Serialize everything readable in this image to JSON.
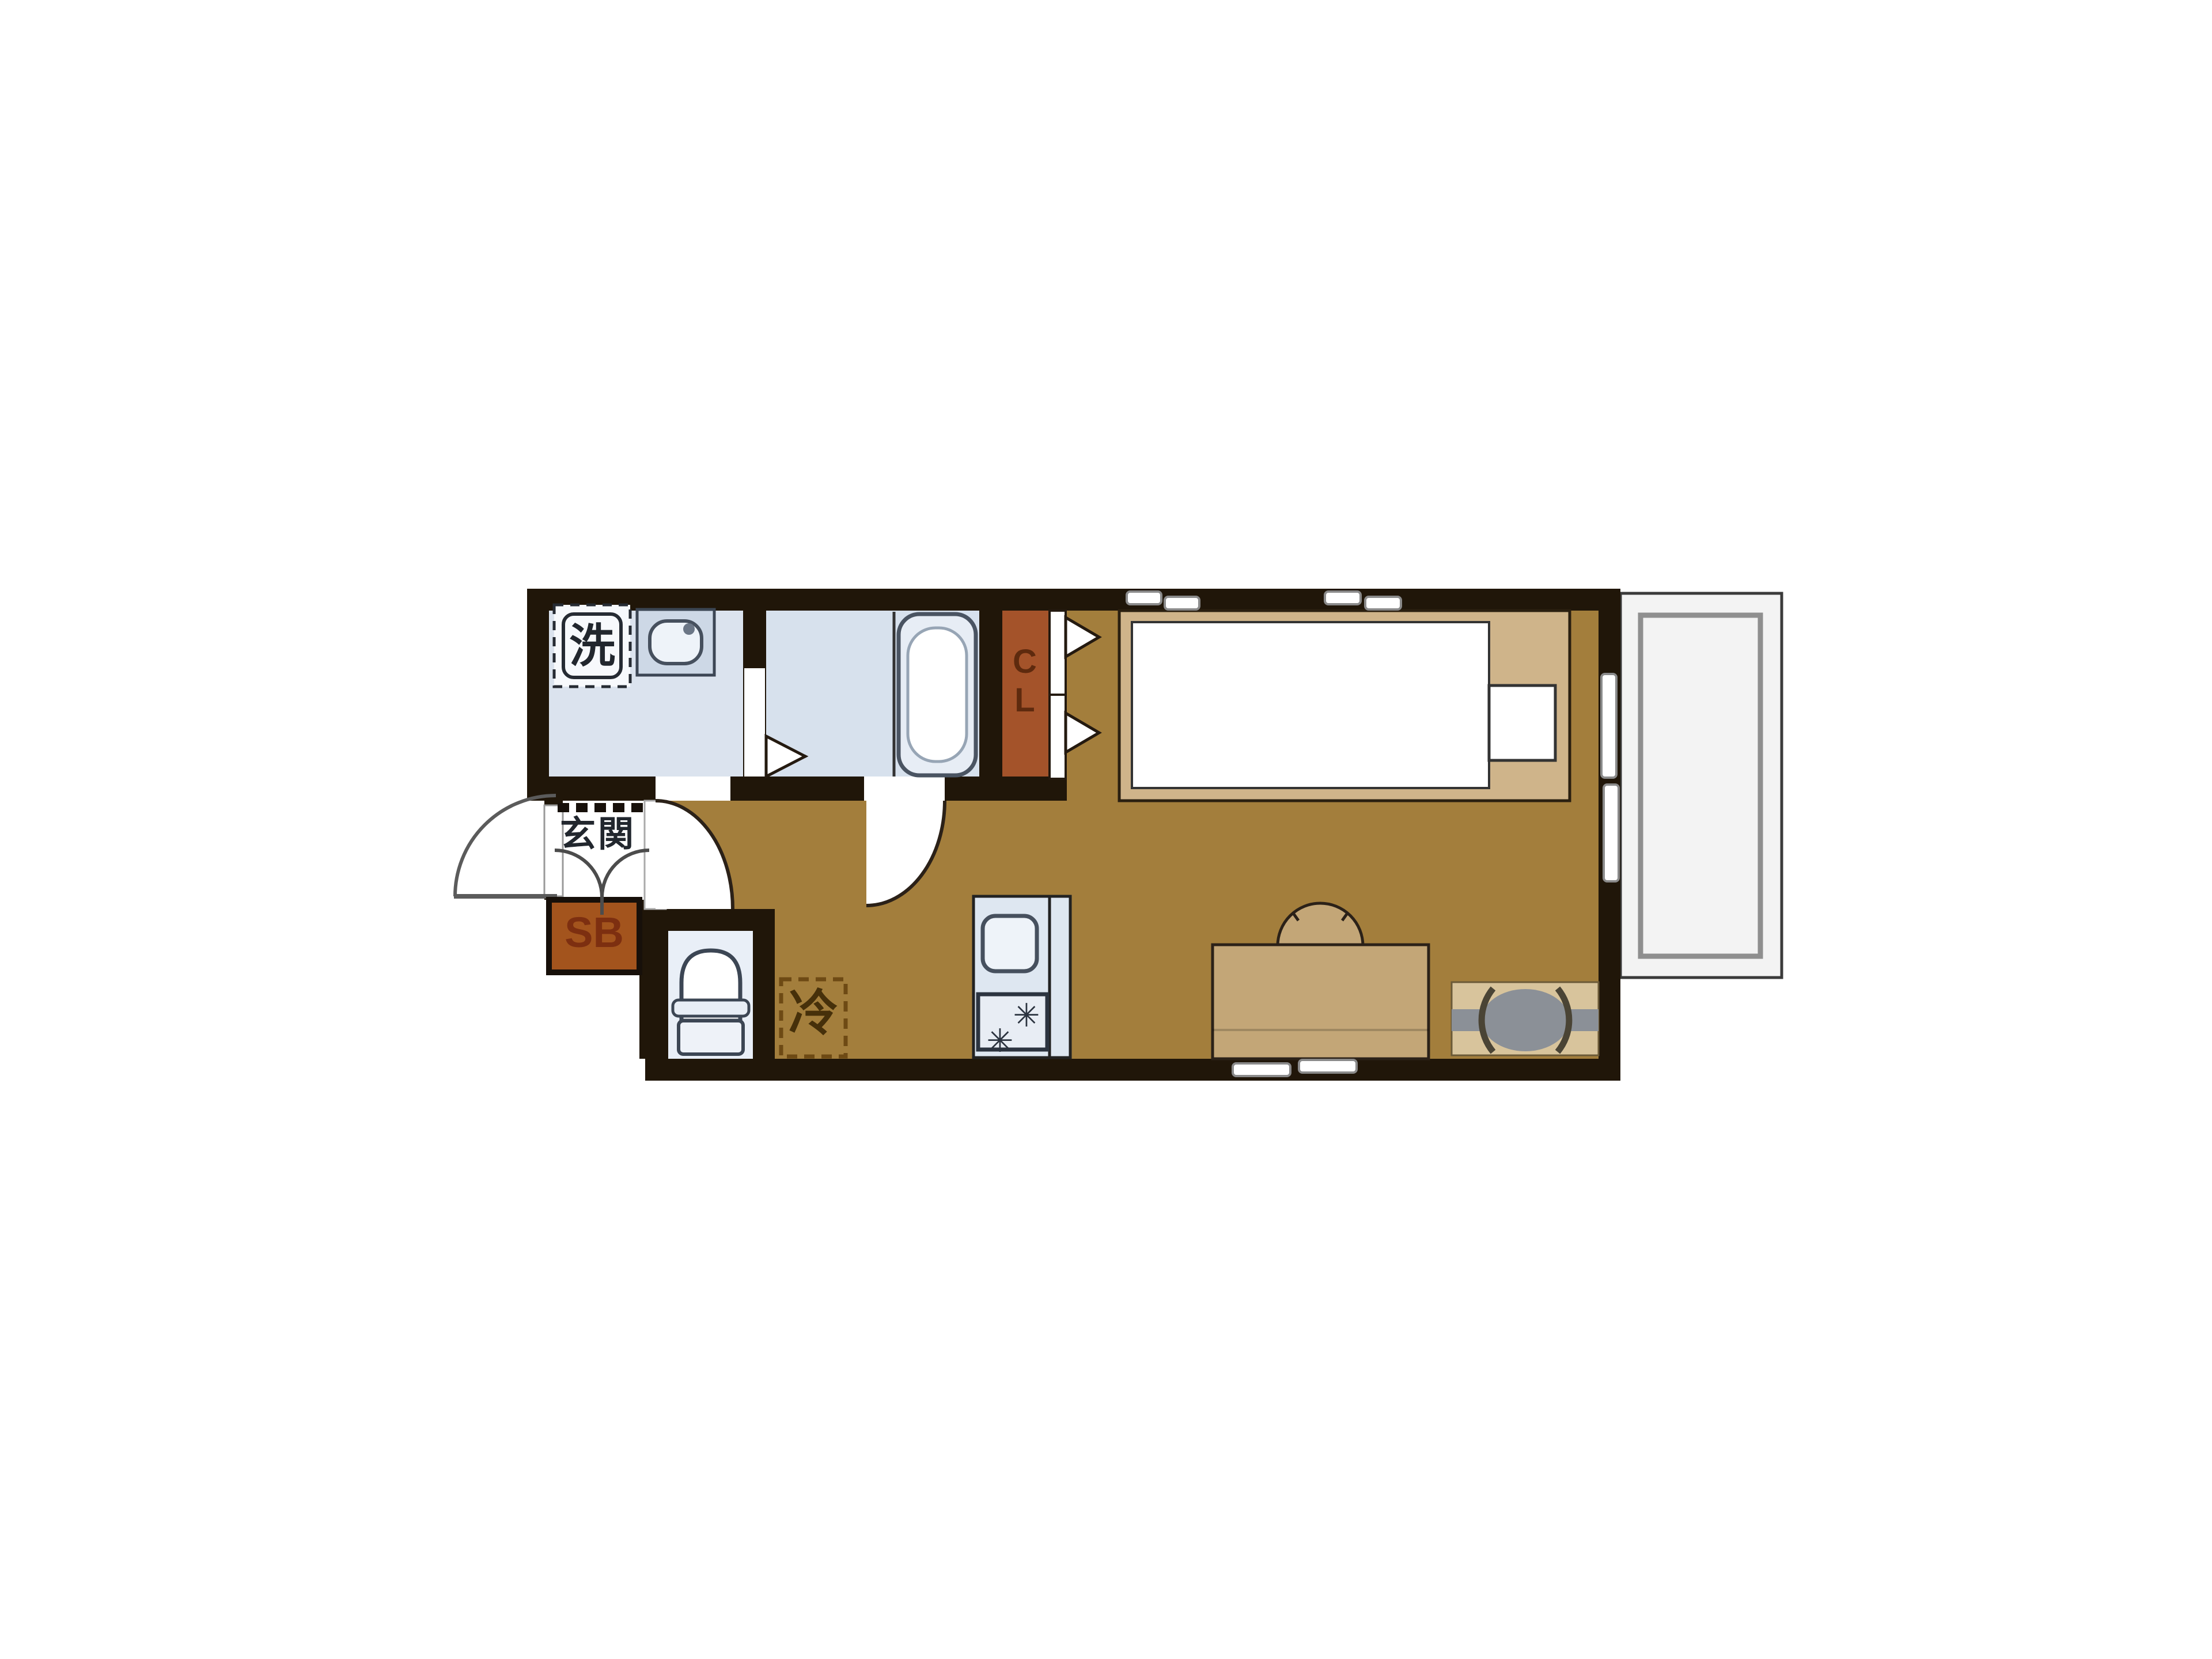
{
  "title": "one-room-apartment-floor-plan",
  "labels": {
    "entrance": "玄関",
    "shoe_box": "SB",
    "closet": "CL",
    "washing_machine": "洗",
    "refrigerator": "冷"
  },
  "colors": {
    "wall": "#201609",
    "floor": "#a37e3c",
    "washroom": "#dbe3ee",
    "bathroom": "#d7e1ed",
    "toilet": "#e9eff7",
    "kitchen": "#dee7f1",
    "closet": "#a4532a",
    "shoebox": "#a3541d",
    "bed_frame": "#cfb48a",
    "furniture_tan": "#c3a677",
    "tv_stand": "#d8c49c",
    "appliance_gray": "#8b9097",
    "balcony": "#f3f3f3",
    "railing": "#8f8f8f",
    "fixture_stroke": "#3c4654",
    "label_dark": "#22272e",
    "closet_text": "#5e2a0e",
    "shoe_box_text": "#7d2f10",
    "refrigerator_text": "#46300a"
  }
}
